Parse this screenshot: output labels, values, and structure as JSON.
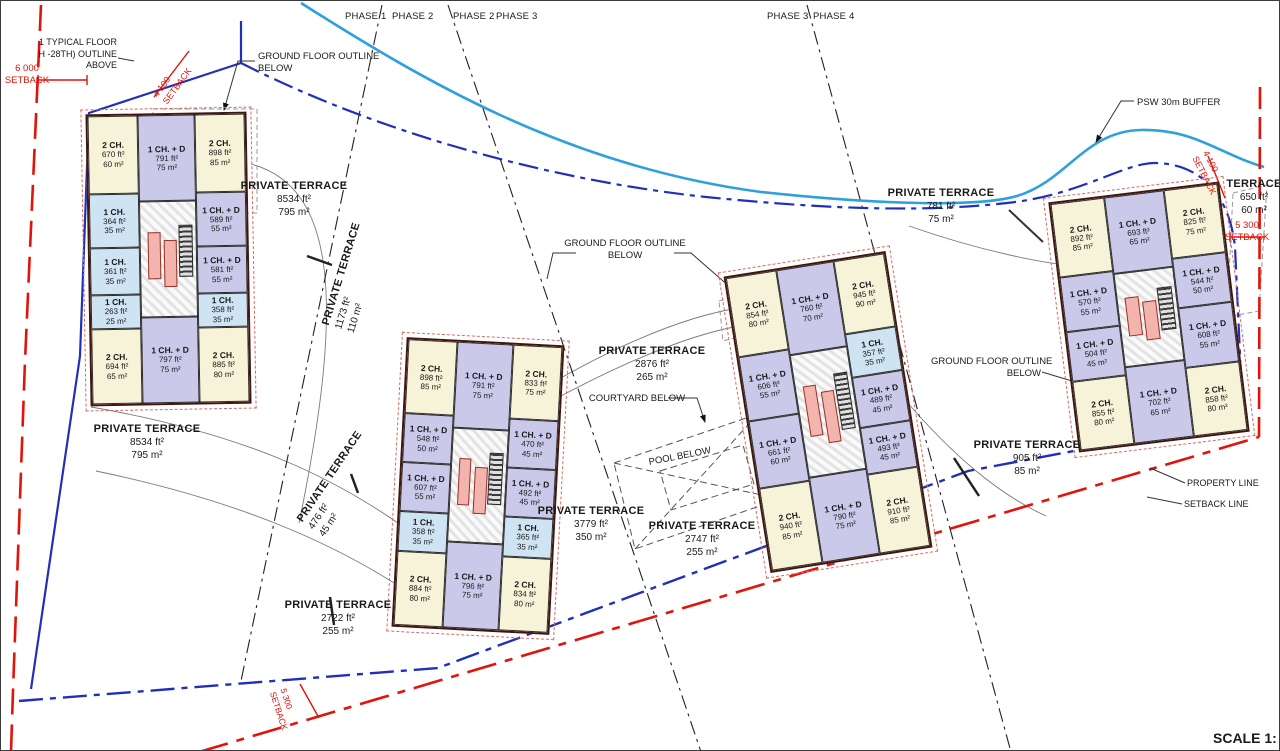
{
  "drawing": {
    "type": "residential site plan",
    "scale_note": "SCALE 1:"
  },
  "colors": {
    "unit_2ch": "#f7f3d8",
    "unit_1ch_d": "#cbc9ea",
    "unit_1ch": "#cfe4f2",
    "property_line_red": "#e0140a",
    "setback_blue": "#2030b8",
    "psw_buffer_blue": "#2ea0dc",
    "building_outline": "#45140b"
  },
  "phases": [
    {
      "label": "PHASE 1",
      "x": 344
    },
    {
      "label": "PHASE 2",
      "x": 391
    },
    {
      "label": "PHASE 2",
      "x": 452
    },
    {
      "label": "PHASE 3",
      "x": 495
    },
    {
      "label": "PHASE 3",
      "x": 766
    },
    {
      "label": "PHASE 4",
      "x": 812
    }
  ],
  "labels": [
    {
      "name": "note-typical-floor",
      "x": 0,
      "y": 36,
      "w": 116,
      "align": "right",
      "size": 9,
      "lines": [
        "1 TYPICAL FLOOR",
        "H -28TH) OUTLINE",
        "ABOVE"
      ]
    },
    {
      "name": "dim-6000-setback",
      "x": 26,
      "y": 62,
      "w": 66,
      "color": "red",
      "size": 9.5,
      "lines": [
        "6 000",
        "SETBACK"
      ]
    },
    {
      "name": "dim-4100-setback-left",
      "x": 150,
      "y": 92,
      "rot": -54,
      "align": "left",
      "color": "red",
      "size": 9,
      "lines": [
        "4 100",
        "SETBACK"
      ]
    },
    {
      "name": "note-ground-floor-outline-left",
      "x": 257,
      "y": 50,
      "align": "left",
      "size": 9.5,
      "lines": [
        "GROUND FLOOR OUTLINE",
        "BELOW"
      ]
    },
    {
      "name": "terrace-b1-upper",
      "x": 293,
      "y": 178,
      "title": "PRIVATE TERRACE",
      "lines": [
        "8534 ft²",
        "795 m²"
      ]
    },
    {
      "name": "terrace-1173",
      "x": 318,
      "y": 322,
      "rot": -73,
      "align": "left",
      "title": "PRIVATE TERRACE",
      "lines": [
        "1173 ft²",
        "110 m²"
      ]
    },
    {
      "name": "terrace-b1-lower",
      "x": 146,
      "y": 421,
      "title": "PRIVATE TERRACE",
      "lines": [
        "8534 ft²",
        "795 m²"
      ]
    },
    {
      "name": "terrace-476",
      "x": 293,
      "y": 516,
      "rot": -56,
      "align": "left",
      "title": "PRIVATE TERRACE",
      "lines": [
        "476 ft²",
        "45 m²"
      ]
    },
    {
      "name": "terrace-2722",
      "x": 337,
      "y": 597,
      "title": "PRIVATE TERRACE",
      "lines": [
        "2722 ft²",
        "255 m²"
      ]
    },
    {
      "name": "note-ground-floor-outline-center",
      "x": 624,
      "y": 237,
      "size": 9.5,
      "lines": [
        "GROUND FLOOR  OUTLINE",
        "BELOW"
      ]
    },
    {
      "name": "terrace-2876",
      "x": 651,
      "y": 343,
      "title": "PRIVATE TERRACE",
      "lines": [
        "2876 ft²",
        "265 m²"
      ]
    },
    {
      "name": "note-courtyard-below",
      "x": 636,
      "y": 392,
      "size": 9.5,
      "lines": [
        "COURTYARD BELOW"
      ]
    },
    {
      "name": "note-pool-below",
      "x": 679,
      "y": 450,
      "rot": -11,
      "size": 9.5,
      "lines": [
        "POOL BELOW"
      ]
    },
    {
      "name": "terrace-3779",
      "x": 590,
      "y": 503,
      "title": "PRIVATE TERRACE",
      "lines": [
        "3779 ft²",
        "350 m²"
      ]
    },
    {
      "name": "terrace-2747",
      "x": 701,
      "y": 518,
      "title": "PRIVATE TERRACE",
      "lines": [
        "2747 ft²",
        "255 m²"
      ]
    },
    {
      "name": "terrace-781",
      "x": 940,
      "y": 185,
      "title": "PRIVATE TERRACE",
      "lines": [
        "781 ft²",
        "75 m²"
      ]
    },
    {
      "name": "note-psw-buffer",
      "x": 1136,
      "y": 96,
      "align": "left",
      "size": 9.5,
      "lines": [
        "PSW 30m BUFFER"
      ]
    },
    {
      "name": "terrace-650",
      "x": 1253,
      "y": 176,
      "title": "TERRACE",
      "lines": [
        "650 ft²",
        "60 m²"
      ]
    },
    {
      "name": "dim-4100-setback-right",
      "x": 1209,
      "y": 148,
      "rot": 63,
      "align": "left",
      "color": "red",
      "size": 9,
      "lines": [
        "4 100",
        "SETBACK"
      ]
    },
    {
      "name": "dim-5300-setback-right",
      "x": 1246,
      "y": 219,
      "color": "red",
      "size": 9.5,
      "lines": [
        "5 300",
        "SETBACK"
      ]
    },
    {
      "name": "note-ground-floor-outline-right",
      "x": 930,
      "y": 355,
      "align": "right",
      "w": 110,
      "size": 9.5,
      "lines": [
        "GROUND FLOOR  OUTLINE",
        "BELOW"
      ]
    },
    {
      "name": "terrace-905",
      "x": 1026,
      "y": 437,
      "title": "PRIVATE TERRACE",
      "lines": [
        "905 ft²",
        "85 m²"
      ]
    },
    {
      "name": "note-property-line",
      "x": 1186,
      "y": 477,
      "align": "left",
      "size": 9,
      "lines": [
        "PROPERTY LINE"
      ]
    },
    {
      "name": "note-setback-line",
      "x": 1183,
      "y": 498,
      "align": "left",
      "size": 9,
      "lines": [
        "SETBACK LINE"
      ]
    },
    {
      "name": "dim-setback-bottom",
      "x": 287,
      "y": 686,
      "rot": 72,
      "align": "left",
      "color": "red",
      "size": 8.5,
      "lines": [
        "5 300",
        "SETBACK"
      ]
    },
    {
      "name": "scale-note",
      "x": 1212,
      "y": 728,
      "align": "left",
      "size": 14,
      "bold": true,
      "lines": [
        "SCALE 1:"
      ]
    }
  ],
  "buildings": [
    {
      "name": "building-1",
      "x": 87,
      "y": 112,
      "w": 161,
      "h": 292,
      "rot": -1,
      "left": [
        {
          "t": "2 CH.",
          "ft": "670 ft²",
          "m": "60 m²",
          "c": "c2",
          "h": 27
        },
        {
          "t": "1 CH.",
          "ft": "364 ft²",
          "m": "35 m²",
          "c": "c1",
          "h": 19
        },
        {
          "t": "1 CH.",
          "ft": "361 ft²",
          "m": "35 m²",
          "c": "c1",
          "h": 16
        },
        {
          "t": "1 CH.",
          "ft": "263 ft²",
          "m": "25 m²",
          "c": "c1",
          "h": 12
        },
        {
          "t": "2 CH.",
          "ft": "694 ft²",
          "m": "65 m²",
          "c": "c2",
          "h": 26
        }
      ],
      "mid_top": {
        "t": "1 CH. + D",
        "ft": "791 ft²",
        "m": "75 m²",
        "c": "cd",
        "h": 30
      },
      "mid_bottom": {
        "t": "1 CH. + D",
        "ft": "797 ft²",
        "m": "75 m²",
        "c": "cd",
        "h": 30
      },
      "right": [
        {
          "t": "2 CH.",
          "ft": "898 ft²",
          "m": "85 m²",
          "c": "c2",
          "h": 27
        },
        {
          "t": "1 CH. + D",
          "ft": "589 ft²",
          "m": "55 m²",
          "c": "cd",
          "h": 19
        },
        {
          "t": "1 CH. + D",
          "ft": "581 ft²",
          "m": "55 m²",
          "c": "cd",
          "h": 16
        },
        {
          "t": "1 CH.",
          "ft": "358 ft²",
          "m": "35 m²",
          "c": "c1",
          "h": 12
        },
        {
          "t": "2 CH.",
          "ft": "885 ft²",
          "m": "80 m²",
          "c": "c2",
          "h": 26
        }
      ]
    },
    {
      "name": "building-2",
      "x": 398,
      "y": 340,
      "w": 158,
      "h": 290,
      "rot": 3,
      "left": [
        {
          "t": "2 CH.",
          "ft": "898 ft²",
          "m": "85 m²",
          "c": "c2",
          "h": 26
        },
        {
          "t": "1 CH. + D",
          "ft": "548 ft²",
          "m": "50 m²",
          "c": "cd",
          "h": 17
        },
        {
          "t": "1 CH. + D",
          "ft": "607 ft²",
          "m": "55 m²",
          "c": "cd",
          "h": 17
        },
        {
          "t": "1 CH.",
          "ft": "358 ft²",
          "m": "35 m²",
          "c": "c1",
          "h": 14
        },
        {
          "t": "2 CH.",
          "ft": "884 ft²",
          "m": "80 m²",
          "c": "c2",
          "h": 26
        }
      ],
      "mid_top": {
        "t": "1 CH. + D",
        "ft": "791 ft²",
        "m": "75 m²",
        "c": "cd",
        "h": 30
      },
      "mid_bottom": {
        "t": "1 CH. + D",
        "ft": "796 ft²",
        "m": "75 m²",
        "c": "cd",
        "h": 30
      },
      "right": [
        {
          "t": "2 CH.",
          "ft": "833 ft²",
          "m": "75 m²",
          "c": "c2",
          "h": 26
        },
        {
          "t": "1 CH. + D",
          "ft": "470 ft²",
          "m": "45 m²",
          "c": "cd",
          "h": 17
        },
        {
          "t": "1 CH. + D",
          "ft": "492 ft²",
          "m": "45 m²",
          "c": "cd",
          "h": 17
        },
        {
          "t": "1 CH.",
          "ft": "365 ft²",
          "m": "35 m²",
          "c": "c1",
          "h": 14
        },
        {
          "t": "2 CH.",
          "ft": "834 ft²",
          "m": "80 m²",
          "c": "c2",
          "h": 26
        }
      ]
    },
    {
      "name": "building-3",
      "x": 745,
      "y": 261,
      "w": 164,
      "h": 300,
      "rot": -9,
      "left": [
        {
          "t": "2 CH.",
          "ft": "854 ft²",
          "m": "80 m²",
          "c": "c2",
          "h": 27
        },
        {
          "t": "1 CH. + D",
          "ft": "606 ft²",
          "m": "55 m²",
          "c": "cd",
          "h": 22
        },
        {
          "t": "1 CH. + D",
          "ft": "661 ft²",
          "m": "60 m²",
          "c": "cd",
          "h": 23
        },
        {
          "t": "2 CH.",
          "ft": "940 ft²",
          "m": "85 m²",
          "c": "c2",
          "h": 28
        }
      ],
      "mid_top": {
        "t": "1 CH. + D",
        "ft": "760 ft²",
        "m": "70 m²",
        "c": "cd",
        "h": 29
      },
      "mid_bottom": {
        "t": "1 CH. + D",
        "ft": "790 ft²",
        "m": "75 m²",
        "c": "cd",
        "h": 29
      },
      "right": [
        {
          "t": "2 CH.",
          "ft": "945 ft²",
          "m": "90 m²",
          "c": "c2",
          "h": 25
        },
        {
          "t": "1 CH.",
          "ft": "357 ft²",
          "m": "35 m²",
          "c": "c1",
          "h": 15
        },
        {
          "t": "1 CH. + D",
          "ft": "489 ft²",
          "m": "45 m²",
          "c": "cd",
          "h": 17
        },
        {
          "t": "1 CH. + D",
          "ft": "493 ft²",
          "m": "45 m²",
          "c": "cd",
          "h": 16
        },
        {
          "t": "2 CH.",
          "ft": "910 ft²",
          "m": "85 m²",
          "c": "c2",
          "h": 27
        }
      ]
    },
    {
      "name": "building-4",
      "x": 1062,
      "y": 190,
      "w": 172,
      "h": 252,
      "rot": -7,
      "left": [
        {
          "t": "2 CH.",
          "ft": "892 ft²",
          "m": "85 m²",
          "c": "c2",
          "h": 30
        },
        {
          "t": "1 CH. + D",
          "ft": "570 ft²",
          "m": "55 m²",
          "c": "cd",
          "h": 22
        },
        {
          "t": "1 CH. + D",
          "ft": "504 ft²",
          "m": "45 m²",
          "c": "cd",
          "h": 20
        },
        {
          "t": "2 CH.",
          "ft": "855 ft²",
          "m": "80 m²",
          "c": "c2",
          "h": 28
        }
      ],
      "mid_top": {
        "t": "1 CH. + D",
        "ft": "693 ft²",
        "m": "65 m²",
        "c": "cd",
        "h": 31
      },
      "mid_bottom": {
        "t": "1 CH. + D",
        "ft": "702 ft²",
        "m": "65 m²",
        "c": "cd",
        "h": 31
      },
      "right": [
        {
          "t": "2 CH.",
          "ft": "825 ft²",
          "m": "75 m²",
          "c": "c2",
          "h": 28
        },
        {
          "t": "1 CH. + D",
          "ft": "544 ft²",
          "m": "50 m²",
          "c": "cd",
          "h": 20
        },
        {
          "t": "1 CH. + D",
          "ft": "608 ft²",
          "m": "55 m²",
          "c": "cd",
          "h": 24
        },
        {
          "t": "2 CH.",
          "ft": "858 ft²",
          "m": "80 m²",
          "c": "c2",
          "h": 28
        }
      ]
    }
  ]
}
